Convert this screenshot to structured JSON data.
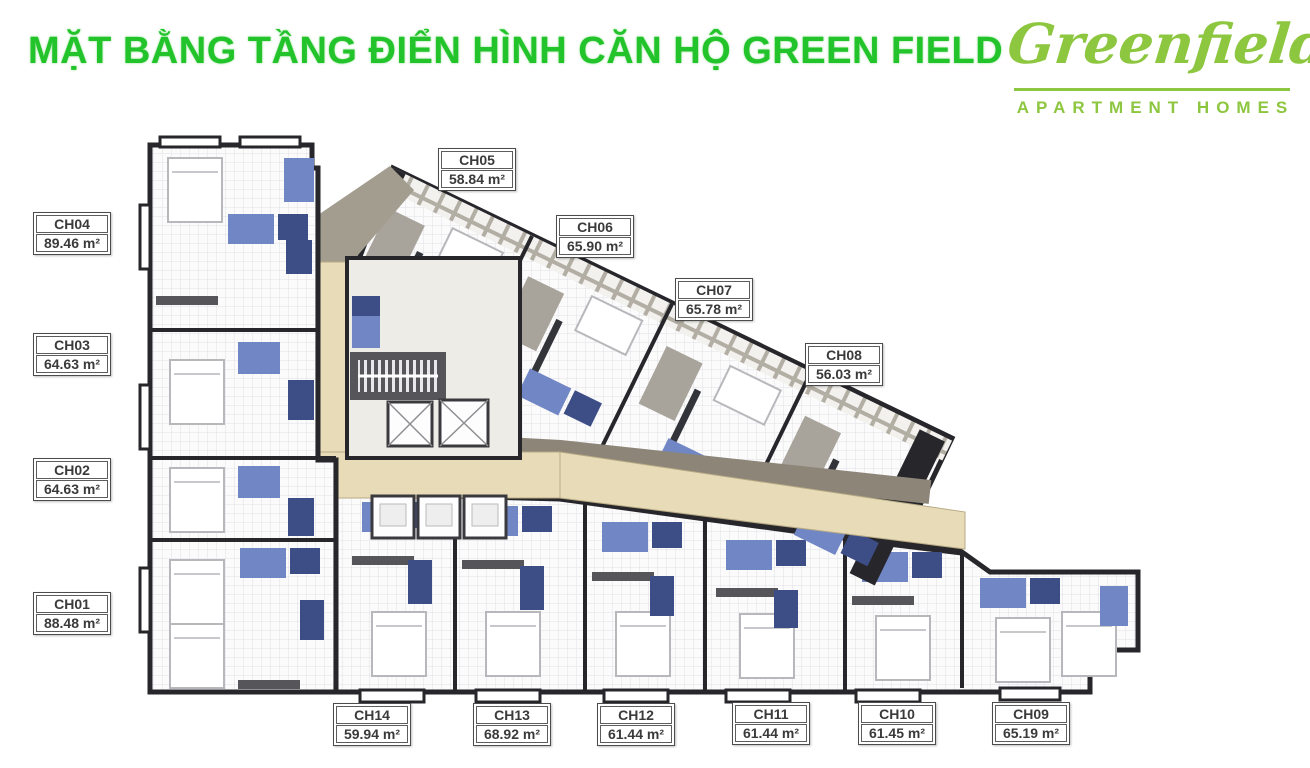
{
  "header": {
    "title": "MẶT BẰNG TẦNG ĐIỂN HÌNH CĂN HỘ GREEN FIELD"
  },
  "logo": {
    "name": "Greenfield",
    "tagline": "APARTMENT HOMES"
  },
  "units": [
    {
      "code": "CH01",
      "area": "88.48 m²"
    },
    {
      "code": "CH02",
      "area": "64.63 m²"
    },
    {
      "code": "CH03",
      "area": "64.63 m²"
    },
    {
      "code": "CH04",
      "area": "89.46 m²"
    },
    {
      "code": "CH05",
      "area": "58.84 m²"
    },
    {
      "code": "CH06",
      "area": "65.90 m²"
    },
    {
      "code": "CH07",
      "area": "65.78 m²"
    },
    {
      "code": "CH08",
      "area": "56.03 m²"
    },
    {
      "code": "CH09",
      "area": "65.19 m²"
    },
    {
      "code": "CH10",
      "area": "61.45 m²"
    },
    {
      "code": "CH11",
      "area": "61.44 m²"
    },
    {
      "code": "CH12",
      "area": "61.44 m²"
    },
    {
      "code": "CH13",
      "area": "68.92 m²"
    },
    {
      "code": "CH14",
      "area": "59.94 m²"
    }
  ],
  "colors": {
    "title_green": "#23c32b",
    "logo_green": "#8dc63f",
    "wall_dark": "#26262b",
    "wall_gray": "#55555a",
    "accent_blue": "#7186c4",
    "accent_navy": "#3d4e86",
    "corridor_tan": "#e8dcb8",
    "taupe": "#8d8578",
    "label_ink": "#3a3a3a"
  }
}
